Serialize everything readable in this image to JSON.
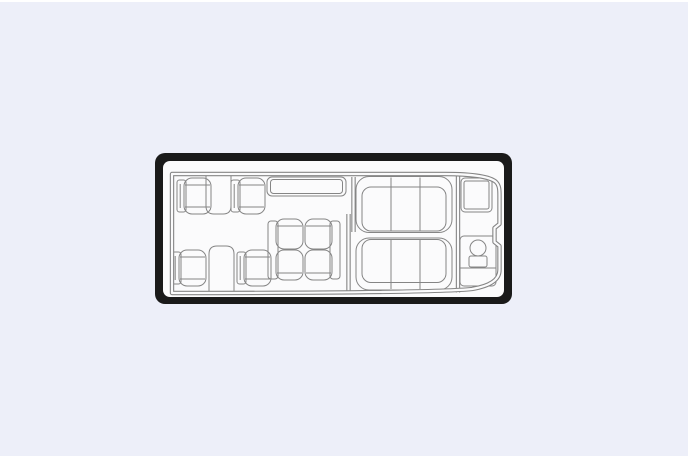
{
  "colors": {
    "page-bg": "#EDEFF9",
    "edge": "#FFFFFF",
    "frame": "#1A1A1A",
    "paper": "#FBFBFC",
    "line": "#858585"
  },
  "diagram": {
    "type": "aircraft cabin floor plan (top view)",
    "orientation": "nose at left, tapered tail at right",
    "total_passenger_seats": 14,
    "sections": [
      {
        "name": "forward-club",
        "contents": [
          "single seat x4 (two rows of two)",
          "wall-mounted side table x2"
        ]
      },
      {
        "name": "mid-cabin",
        "contents": [
          "credenza cabinet along top wall",
          "facing seat pair x2 (four seats)"
        ]
      },
      {
        "name": "aft-cabin",
        "contents": [
          "three-place divan along top wall",
          "three-place divan along bottom wall"
        ]
      },
      {
        "name": "aft-lavatory",
        "contents": [
          "cabinet",
          "toilet with bowl and tank"
        ]
      }
    ]
  }
}
